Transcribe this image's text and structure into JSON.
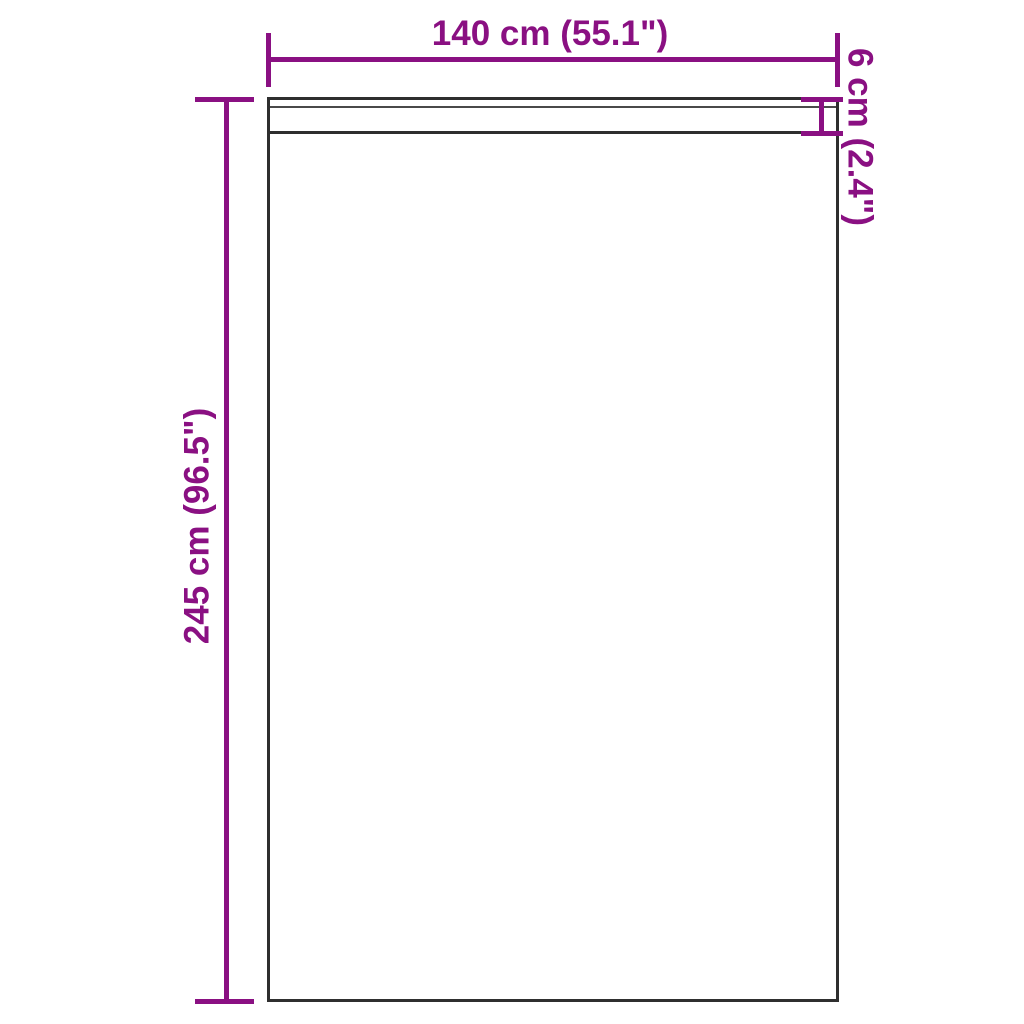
{
  "diagram": {
    "type": "product-dimension-diagram",
    "subject": "curtain panel with rod pocket header",
    "background_color": "#ffffff",
    "accent_color": "#8a1082",
    "outline_color": "#2f2f2f",
    "seam_color": "#4a4a4a",
    "dimensions": {
      "width_label": "140 cm (55.1\")",
      "height_label": "245 cm (96.5\")",
      "header_height_label": "6 cm (2.4\")"
    }
  }
}
